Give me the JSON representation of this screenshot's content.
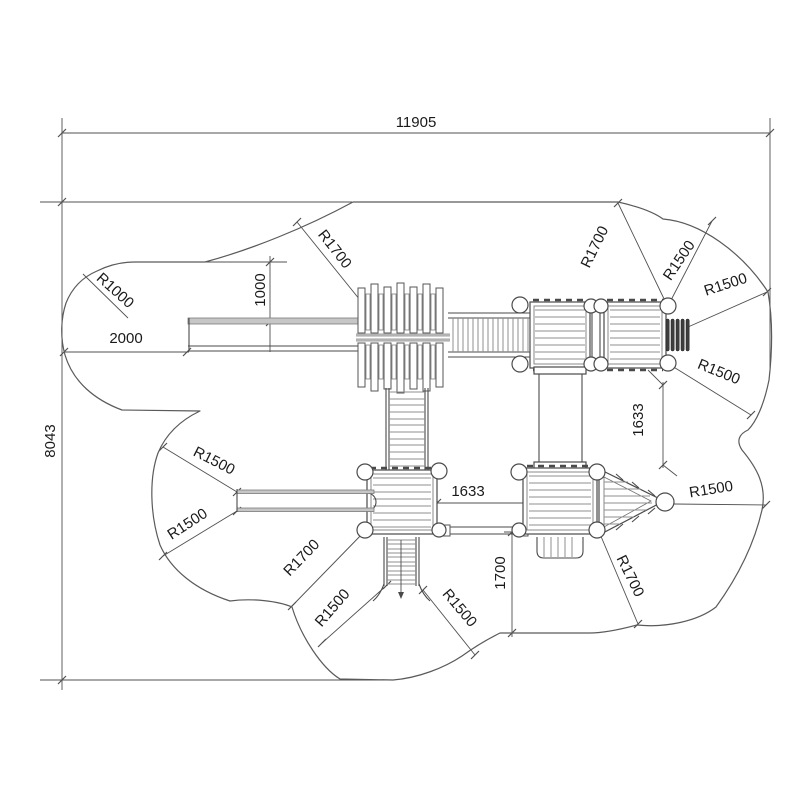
{
  "dimensions": {
    "overall_width": "11905",
    "overall_height": "8043",
    "slide_run": "2000",
    "slide_offset": "1000",
    "platform_gap_horizontal": "1633",
    "platform_gap_vertical": "1633",
    "ladder_clearance": "1700"
  },
  "radii": {
    "r1000": "R1000",
    "r1500": "R1500",
    "r1700": "R1700"
  },
  "colors": {
    "line": "#4a4a4a",
    "dim": "#505050",
    "grayfill": "#c6c6c6",
    "darkfill": "#3e3e3e",
    "bg": "#ffffff",
    "text": "#1a1a1a"
  }
}
